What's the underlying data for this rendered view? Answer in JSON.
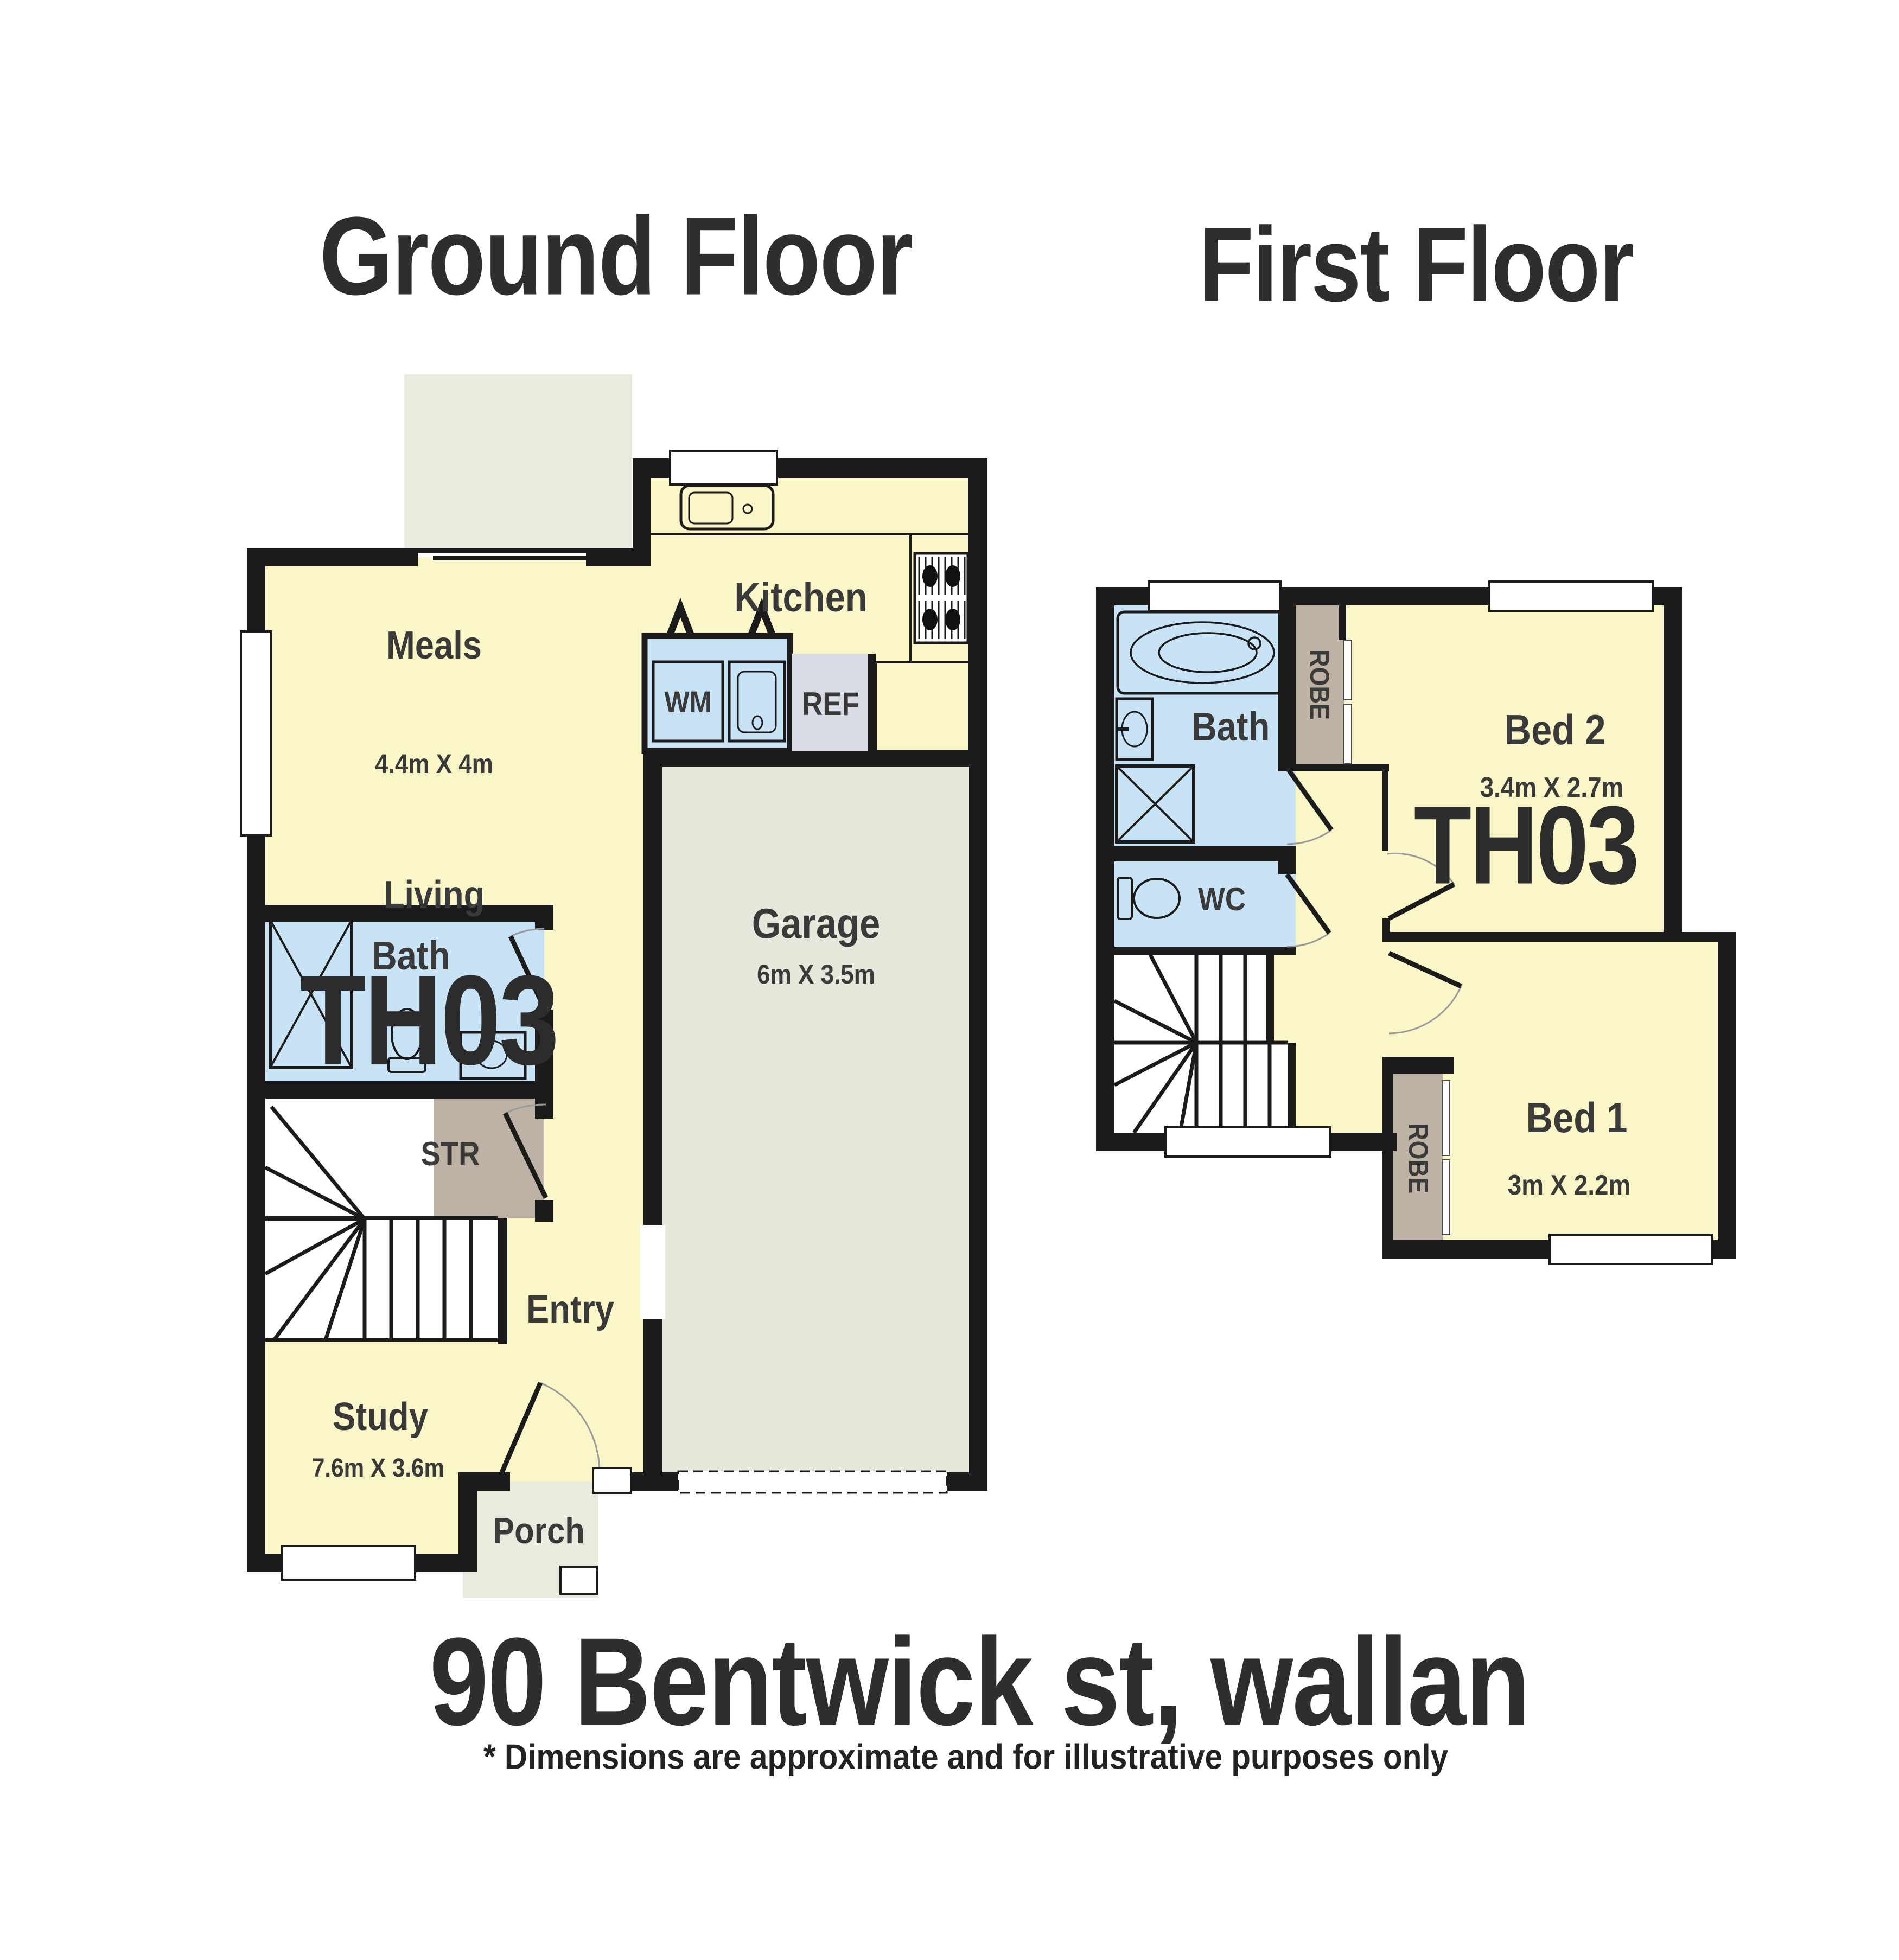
{
  "titles": {
    "ground": "Ground Floor",
    "first": "First Floor"
  },
  "footer": {
    "address": "90 Bentwick st, wallan",
    "disclaimer": "* Dimensions are approximate and for illustrative purposes only"
  },
  "ground": {
    "meals": "Meals",
    "meals_dims": "4.4m X 4m",
    "living": "Living",
    "unit": "TH03",
    "kitchen": "Kitchen",
    "bath": "Bath",
    "str": "STR",
    "entry": "Entry",
    "study": "Study",
    "study_dims": "7.6m X 3.6m",
    "porch": "Porch",
    "garage": "Garage",
    "garage_dims": "6m X 3.5m",
    "wm": "WM",
    "ref": "REF"
  },
  "first": {
    "bath": "Bath",
    "wc": "WC",
    "robe_top": "ROBE",
    "robe_bed1": "ROBE",
    "bed2": "Bed 2",
    "bed2_dims": "3.4m X 2.7m",
    "unit": "TH03",
    "bed1": "Bed 1",
    "bed1_dims": "3m X 2.2m"
  },
  "colors": {
    "room_fill": "#FAF6C8",
    "wet_area_fill": "#C8E2F6",
    "garage_fill": "#E5E8DA",
    "outdoor_fill": "#E9EBDF",
    "fridge_fill": "#DBDDE6",
    "robe_fill": "#BEB2A4",
    "wall": "#1B1B1B",
    "text": "#3A3A3A"
  }
}
